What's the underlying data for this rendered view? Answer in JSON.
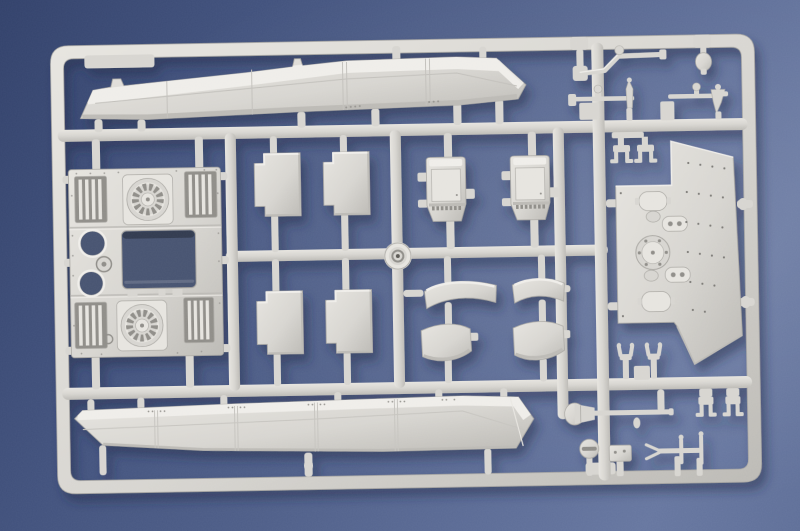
{
  "scene": {
    "description": "Photograph of a light-gray injection-molded styrene sprue (model kit parts tree) of armored-vehicle components lying on a blue textured paper background, lit from upper left with soft shadows.",
    "sprue_material": "light gray styrene plastic",
    "background_surface": "blue mottled paper"
  },
  "palette": {
    "bg_a": "#32416a",
    "bg_b": "#4e5e88",
    "bg_c": "#66769f",
    "plastic_top": "#efede9",
    "plastic_hi": "#e6e4df",
    "plastic_base": "#d7d5d0",
    "plastic_lo": "#bcbab5",
    "plastic_deep": "#8f8d88",
    "plastic_edge": "#aaa8a3",
    "hole": "#47536f",
    "shadow": "#1d2947"
  },
  "parts": [
    {
      "id": "upper-hull-panel",
      "label": "Long angled hull side panel (top of sprue)"
    },
    {
      "id": "engine-deck-plate",
      "label": "Engine deck plate with two round cooling-fan grilles, four slatted intake grilles, rectangular opening and three round ports"
    },
    {
      "id": "hatch-panels",
      "label": "Four rectangular hatch panels with stepped corners (center)"
    },
    {
      "id": "stowage-boxes",
      "label": "Two stowage box parts with vent slits"
    },
    {
      "id": "curved-fenders",
      "label": "Four curved fender sections (two arc panels, two deep sections)"
    },
    {
      "id": "wheel-cap",
      "label": "Small round wheel cap at central runner junction"
    },
    {
      "id": "roof-panel",
      "label": "Large roof plate with oval hatches, bolted ring and rivet rows (right)"
    },
    {
      "id": "tow-clamps",
      "label": "Two small tow clamps above roof plate"
    },
    {
      "id": "clevis-shackles",
      "label": "Two clevis shackle parts below roof plate"
    },
    {
      "id": "lower-hull-panel",
      "label": "Long angled hull side panel (bottom of sprue)"
    },
    {
      "id": "bent-rod",
      "label": "Z-bent grab rod (top right)"
    },
    {
      "id": "ball-knob",
      "label": "Ball knob part (top right)"
    },
    {
      "id": "linkage-rods",
      "label": "Two linkage rods with pins and cone fittings"
    },
    {
      "id": "funnel-rod",
      "label": "Long rod with funnel-shaped tip (bottom right)"
    },
    {
      "id": "mount-brackets",
      "label": "Two U-shaped mounting brackets"
    },
    {
      "id": "slotted-cap",
      "label": "Round slotted cap on post"
    },
    {
      "id": "small-plate",
      "label": "Small rectangular plate on post"
    },
    {
      "id": "pronged-tool",
      "label": "Two-pronged tool bar with cross pins"
    }
  ]
}
